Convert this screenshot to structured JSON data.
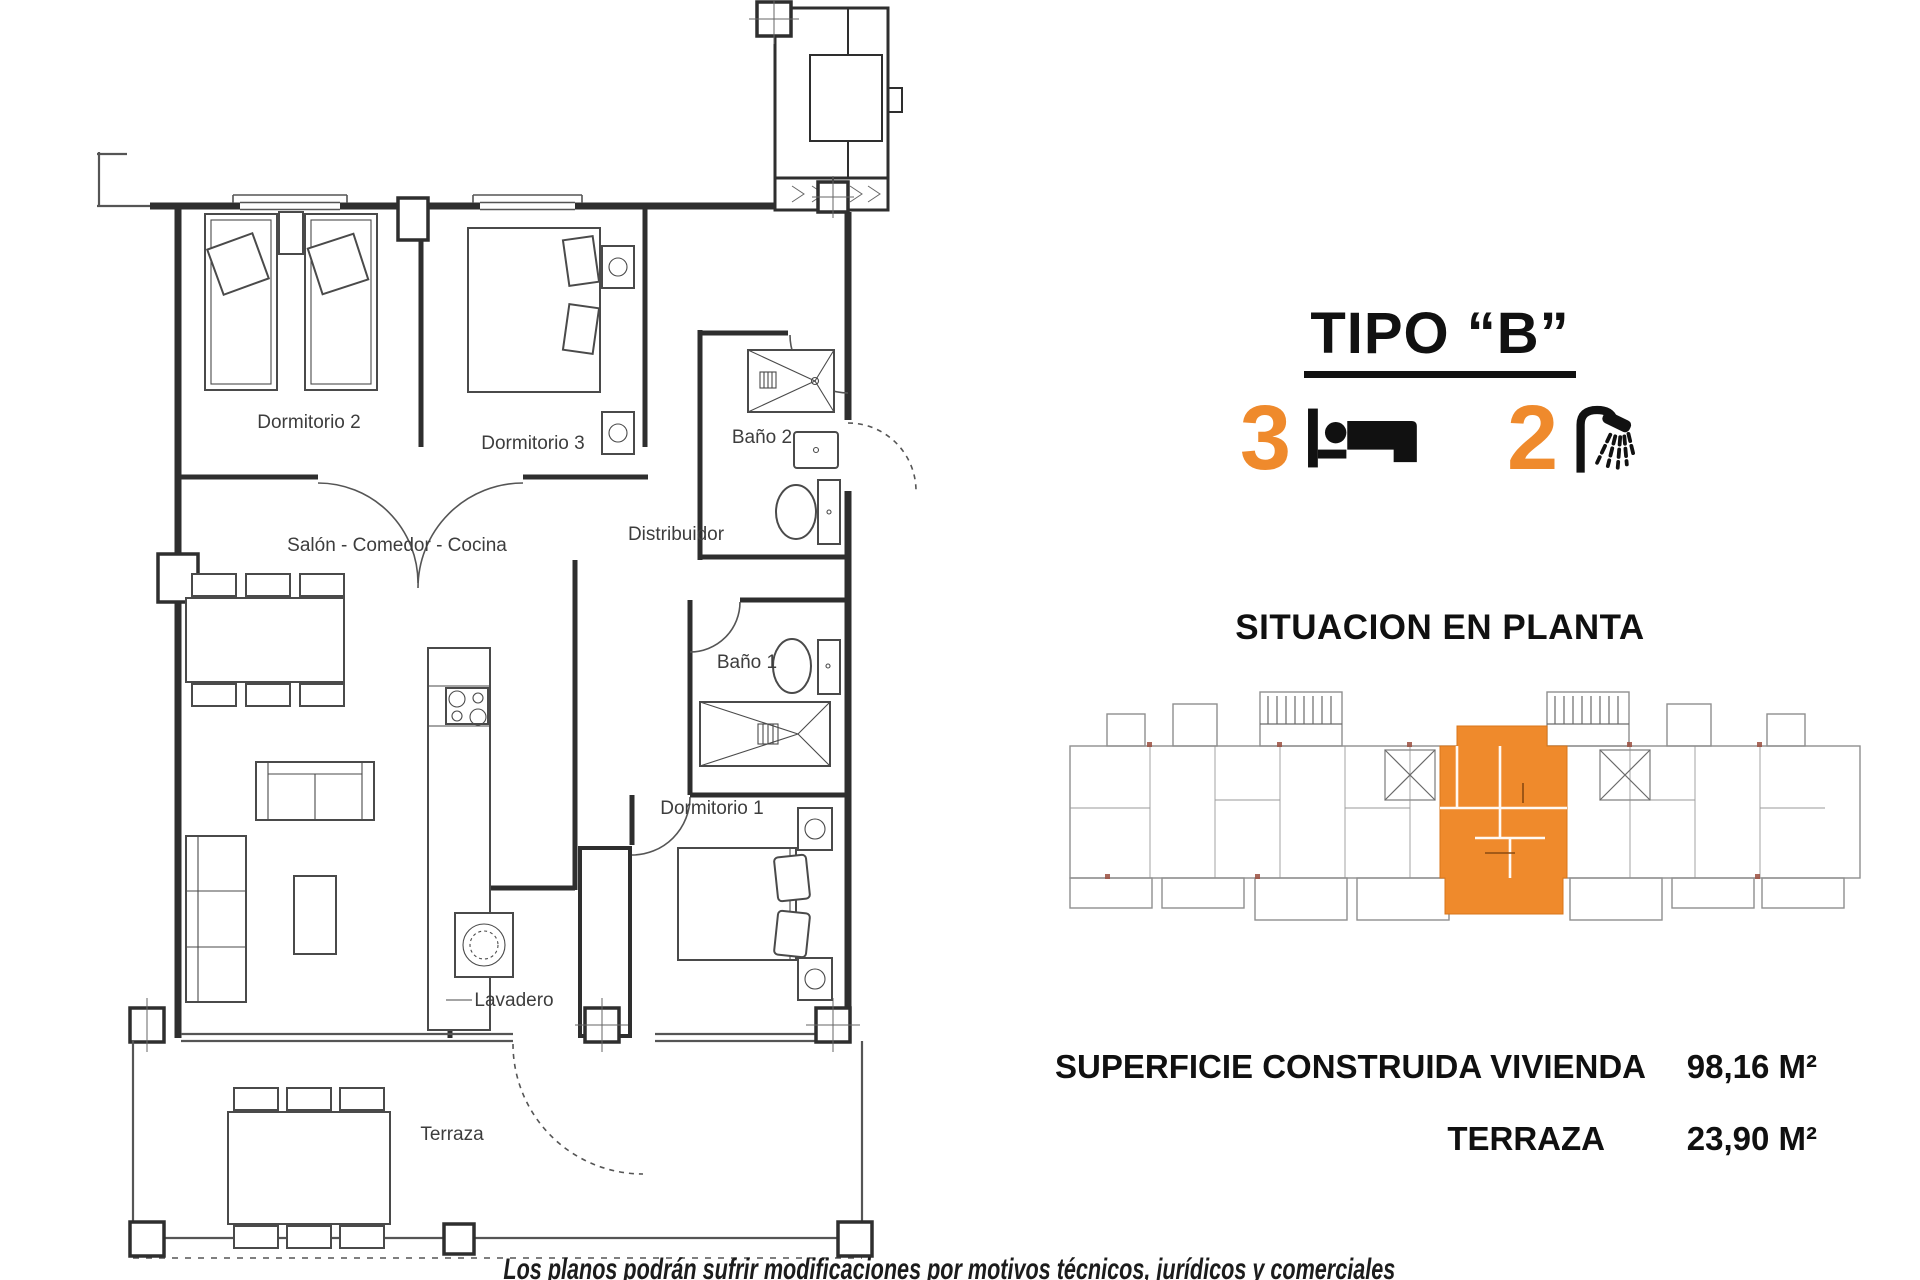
{
  "header": {
    "title": "TIPO “B”"
  },
  "stats": {
    "bedrooms": "3",
    "bathrooms": "2",
    "bed_icon": "bed-icon",
    "shower_icon": "shower-icon"
  },
  "situacion": {
    "heading": "SITUACION EN PLANTA"
  },
  "areas": {
    "rows": [
      {
        "label": "SUPERFICIE CONSTRUIDA VIVIENDA",
        "value": "98,16 M²"
      },
      {
        "label": "TERRAZA",
        "value": "23,90 M²"
      }
    ]
  },
  "floorplan": {
    "rooms": [
      {
        "label": "Dormitorio 2"
      },
      {
        "label": "Dormitorio 3"
      },
      {
        "label": "Baño 2"
      },
      {
        "label": "Distribuidor"
      },
      {
        "label": "Salón - Comedor - Cocina"
      },
      {
        "label": "Baño 1"
      },
      {
        "label": "Dormitorio 1"
      },
      {
        "label": "Lavadero"
      },
      {
        "label": "Terraza"
      }
    ]
  },
  "footer": {
    "disclaimer": "Los planos podrán sufrir modificaciones por motivos técnicos, jurídicos y comerciales"
  },
  "colors": {
    "accent_orange": "#EF8A2C",
    "highlight_unit": "#EF8A2C",
    "plan_line": "#2E2E2E",
    "situacion_line": "#8F8F8F"
  }
}
